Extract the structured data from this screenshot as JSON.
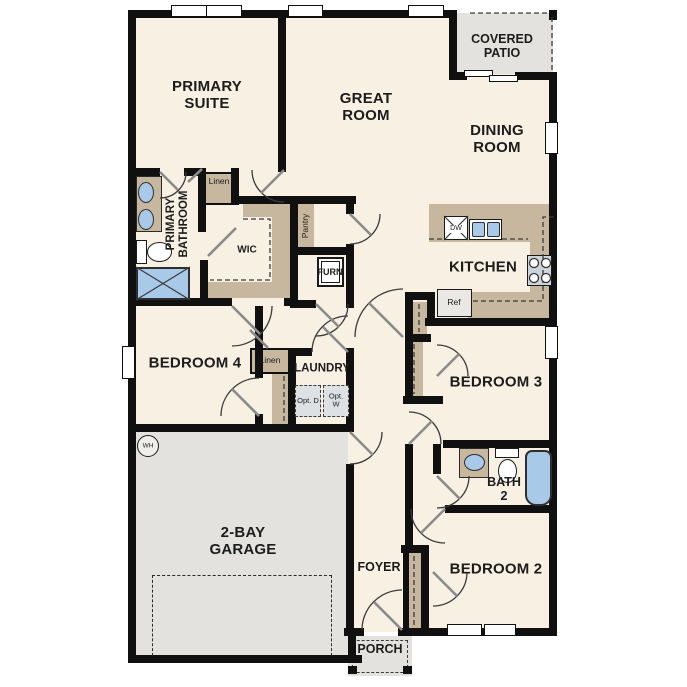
{
  "colors": {
    "floor": "#f8f0e2",
    "wall": "#101010",
    "cabinet_tan": "#c6b79e",
    "concrete_gray": "#e3e2df",
    "fixture_blue": "#a9c9e9",
    "appliance_gray": "#e9e8e4"
  },
  "rooms": {
    "primary_suite": {
      "label": "PRIMARY SUITE"
    },
    "great_room": {
      "label": "GREAT ROOM"
    },
    "dining_room": {
      "label": "DINING ROOM"
    },
    "covered_patio": {
      "label": "COVERED PATIO"
    },
    "primary_bathroom": {
      "label": "PRIMARY BATHROOM"
    },
    "wic": {
      "label": "WIC"
    },
    "linen_bathroom": {
      "label": "Linen"
    },
    "pantry": {
      "label": "Pantry"
    },
    "furnace": {
      "label": "FURN"
    },
    "kitchen": {
      "label": "KITCHEN"
    },
    "bedroom_4": {
      "label": "BEDROOM 4"
    },
    "linen_hall": {
      "label": "Linen"
    },
    "laundry": {
      "label": "LAUNDRY"
    },
    "garage": {
      "label": "2-BAY GARAGE"
    },
    "foyer": {
      "label": "FOYER"
    },
    "porch": {
      "label": "PORCH"
    },
    "bedroom_2": {
      "label": "BEDROOM 2"
    },
    "bath_2": {
      "label": "BATH 2"
    },
    "bedroom_3": {
      "label": "BEDROOM 3"
    }
  },
  "fixtures": {
    "dishwasher": "DW",
    "refrigerator": "Ref",
    "water_heater": "WH",
    "optional_dryer": "Opt. D",
    "optional_washer": "Opt. W"
  }
}
